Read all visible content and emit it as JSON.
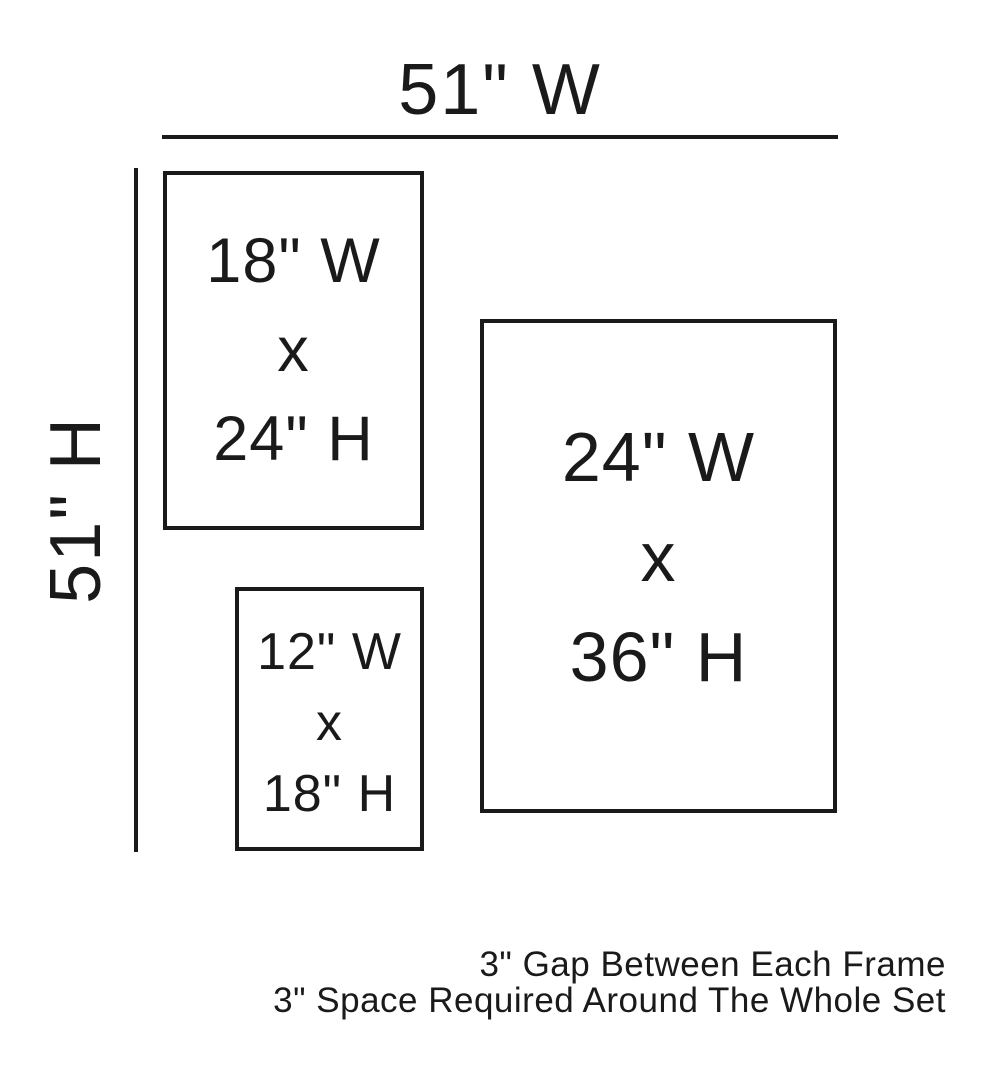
{
  "colors": {
    "ink": "#1a1a1a",
    "background": "#ffffff"
  },
  "dimensions": {
    "total_width": {
      "label": "51\" W"
    },
    "total_height": {
      "label": "51\" H"
    }
  },
  "frames": [
    {
      "width_label": "18\" W",
      "separator": "x",
      "height_label": "24\" H"
    },
    {
      "width_label": "12\" W",
      "separator": "x",
      "height_label": "18\" H"
    },
    {
      "width_label": "24\" W",
      "separator": "x",
      "height_label": "36\" H"
    }
  ],
  "notes": {
    "line1": "3\" Gap Between Each Frame",
    "line2": "3\" Space Required Around The Whole Set"
  }
}
